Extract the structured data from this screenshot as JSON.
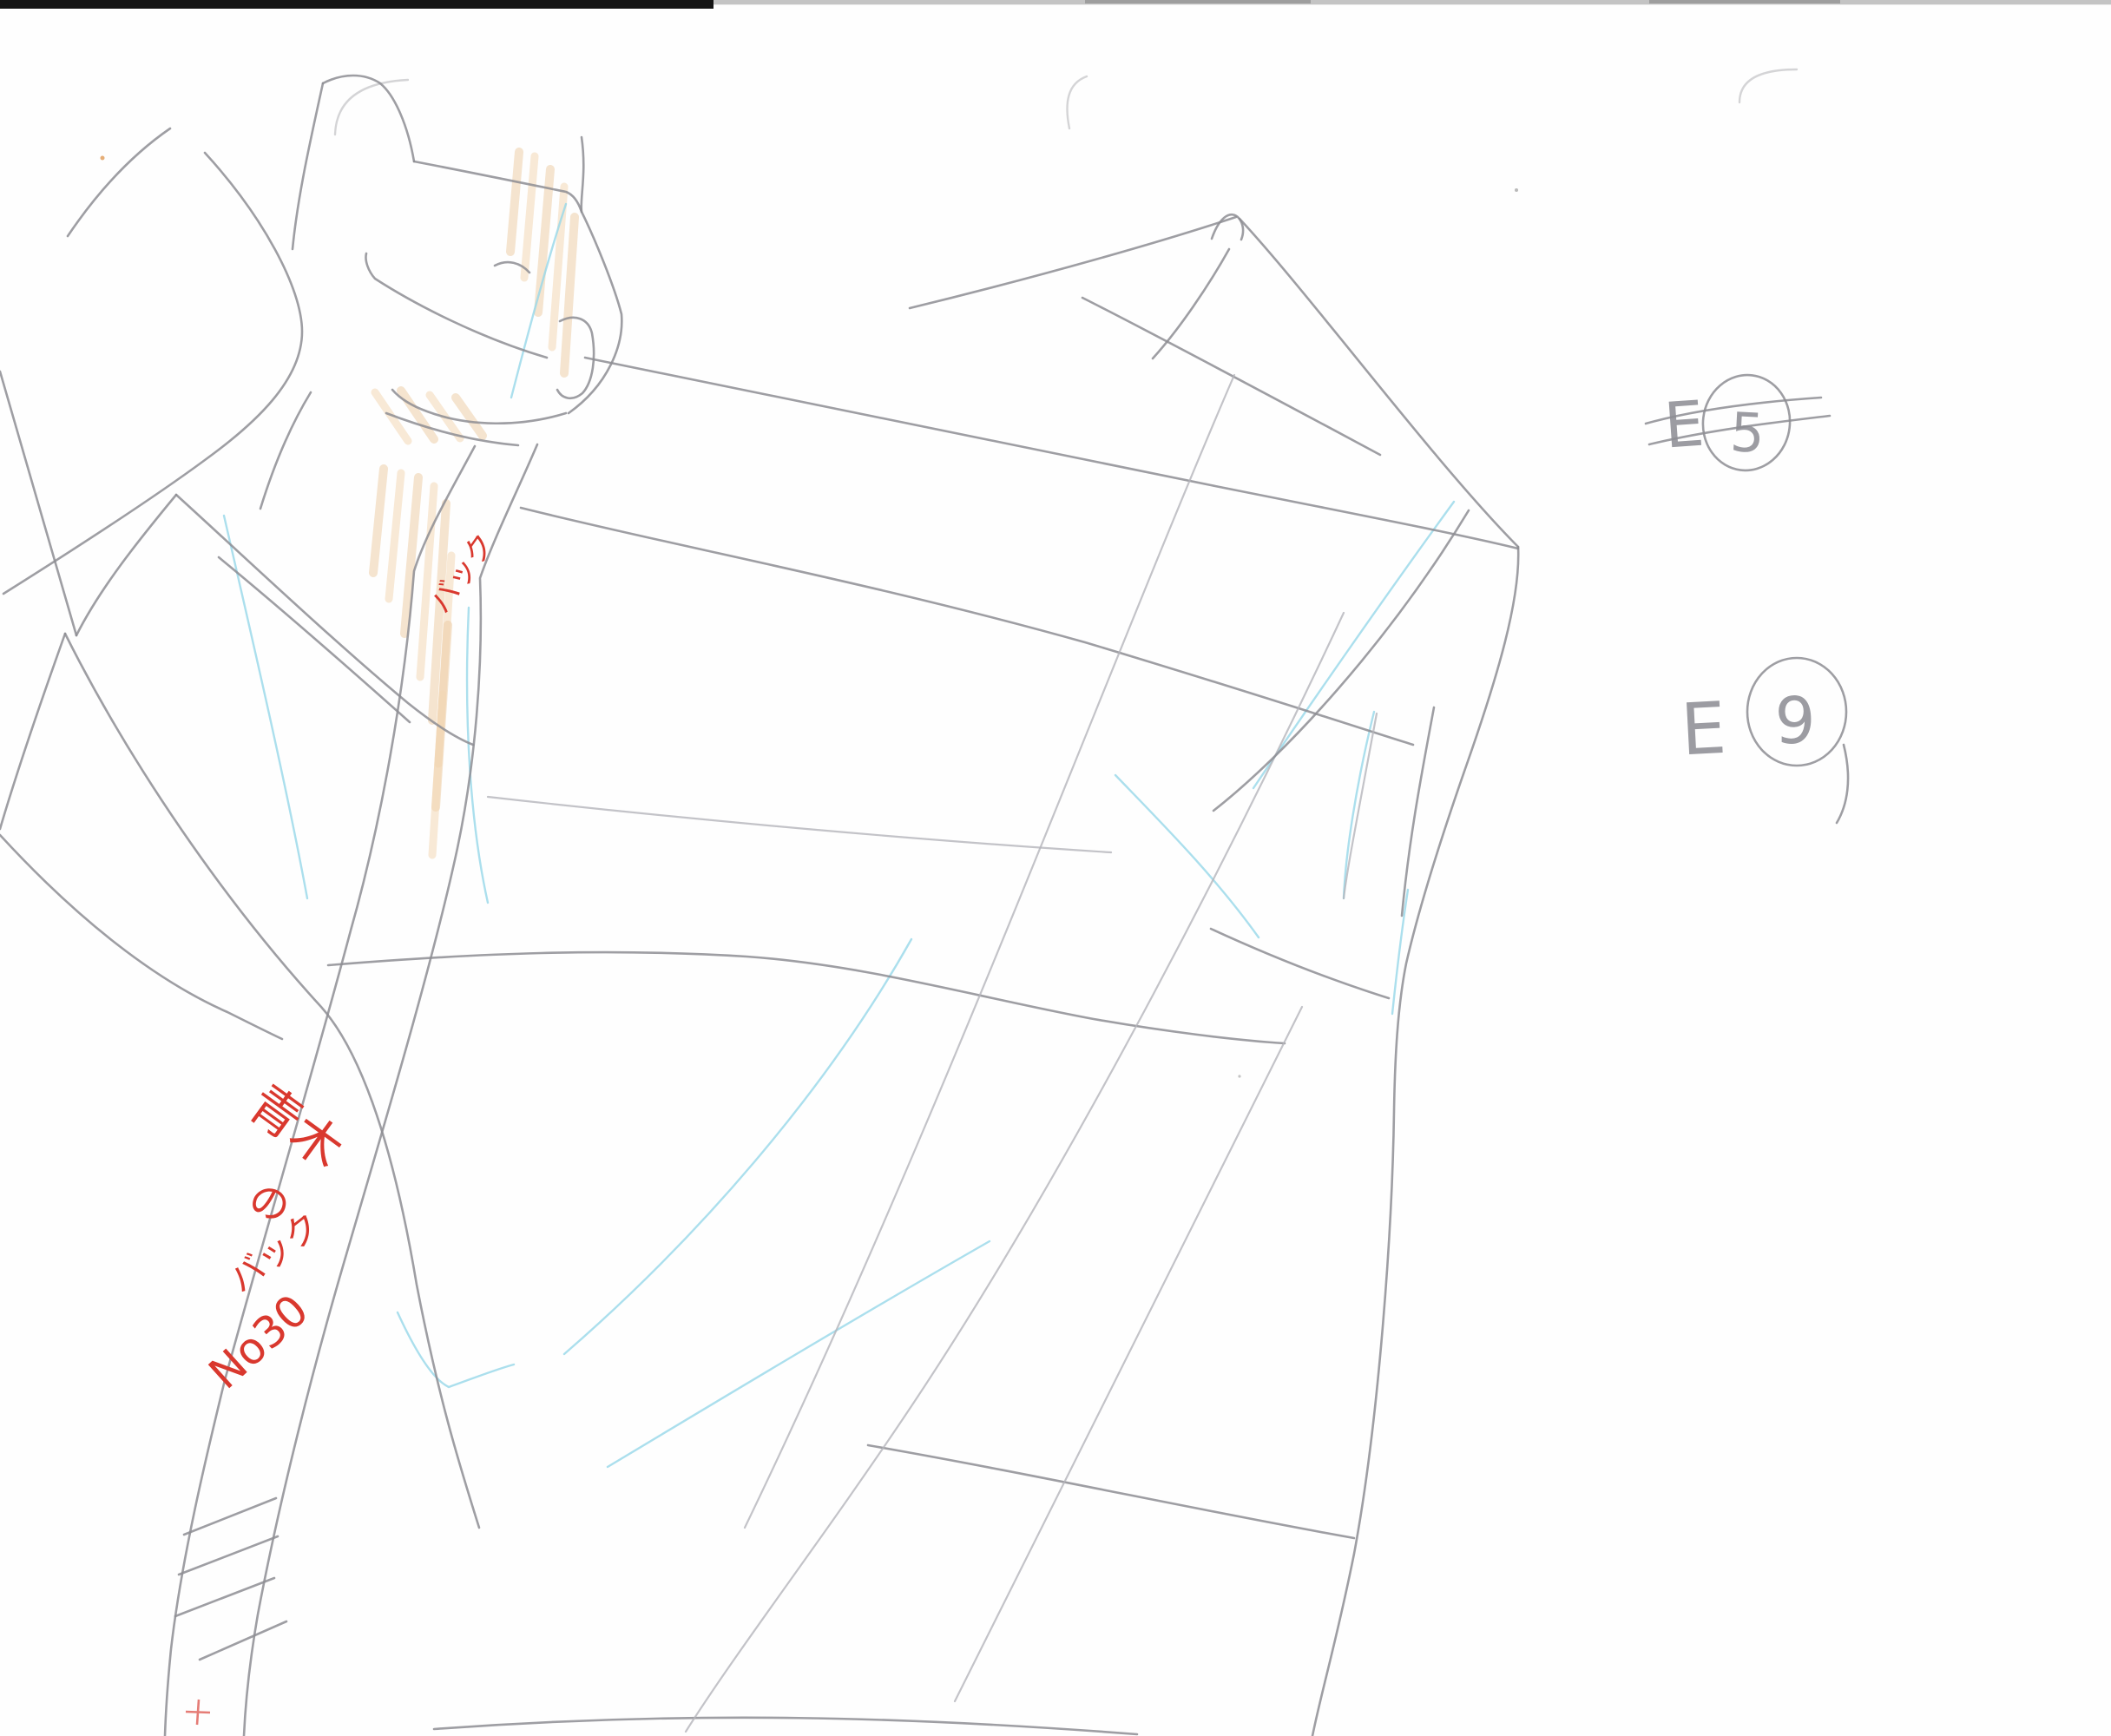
{
  "annotations": {
    "strap_note": "バック",
    "bag_note_line1": "青木",
    "bag_note_line2": "の",
    "bag_note_line3": "バック",
    "bag_note_line4": "No30",
    "cut_e5": {
      "letter": "E",
      "number": "5",
      "crossed_out": true
    },
    "cut_e9": {
      "letter": "E",
      "number": "9",
      "crossed_out": false
    }
  },
  "colors": {
    "pencil": "#8d8d93",
    "pencil_light": "#b4b4ba",
    "blue_pencil": "#96d7e8",
    "skin": "#ecc9a0",
    "skin2": "#f2d7b4",
    "red": "#d9382e",
    "scan_bar": "#141414",
    "paper": "#fefefe",
    "corner_mark": "#cfcfd2"
  }
}
